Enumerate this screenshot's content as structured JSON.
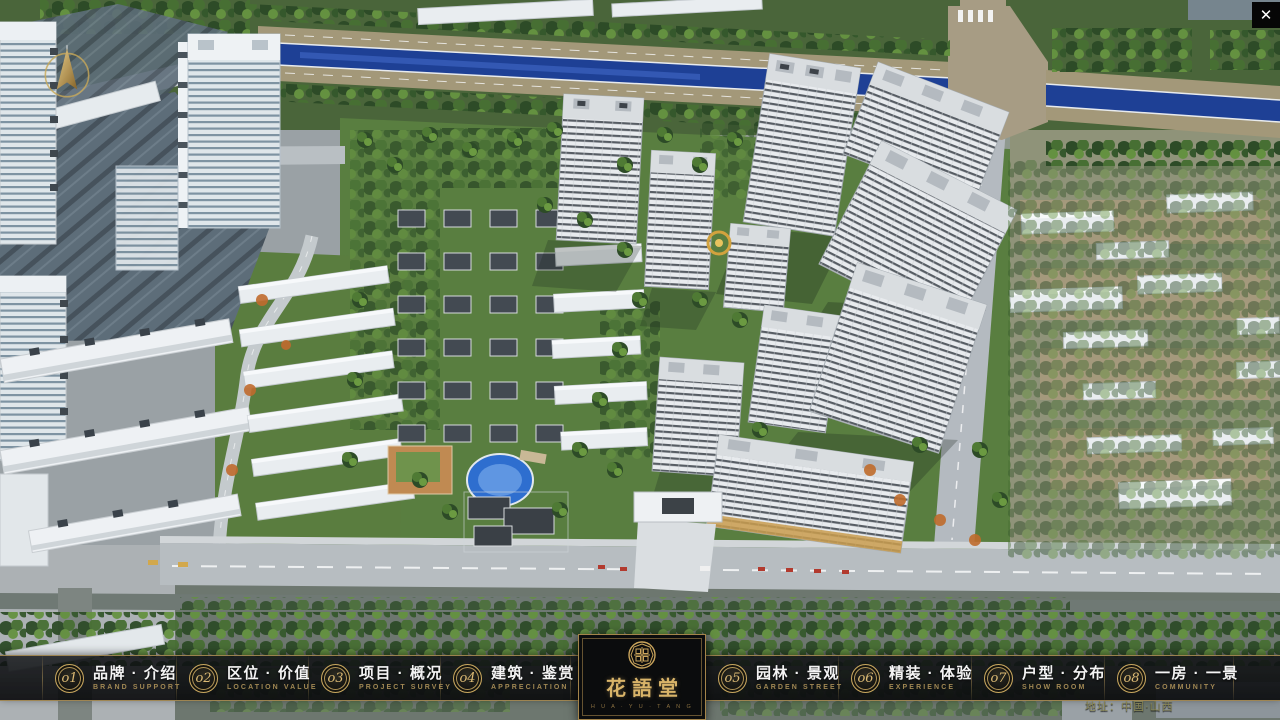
{
  "theme": {
    "gold_accent": "#c9a45f",
    "bar_background": "#0b0d0f",
    "river_blue": "#1e4095",
    "label_white": "#f4f4f4",
    "label_gold": "#a08753"
  },
  "window": {
    "close_label": "✕"
  },
  "nav": {
    "items": [
      {
        "num": "o1",
        "zh": "品牌 · 介绍",
        "en": "BRAND SUPPORT"
      },
      {
        "num": "o2",
        "zh": "区位 · 价值",
        "en": "LOCATION VALUE"
      },
      {
        "num": "o3",
        "zh": "项目 · 概况",
        "en": "PROJECT SURVEY"
      },
      {
        "num": "o4",
        "zh": "建筑 · 鉴赏",
        "en": "APPRECIATION"
      },
      {
        "num": "o5",
        "zh": "园林 · 景观",
        "en": "GARDEN STREET"
      },
      {
        "num": "o6",
        "zh": "精装 · 体验",
        "en": "EXPERIENCE"
      },
      {
        "num": "o7",
        "zh": "户型 · 分布",
        "en": "SHOW ROOM"
      },
      {
        "num": "o8",
        "zh": "一房 · 一景",
        "en": "COMMUNITY"
      }
    ]
  },
  "logo": {
    "name": "花語堂",
    "subtitle": "H U A · Y U · T A N G"
  },
  "footer": {
    "address": "地址：中国·山西"
  }
}
